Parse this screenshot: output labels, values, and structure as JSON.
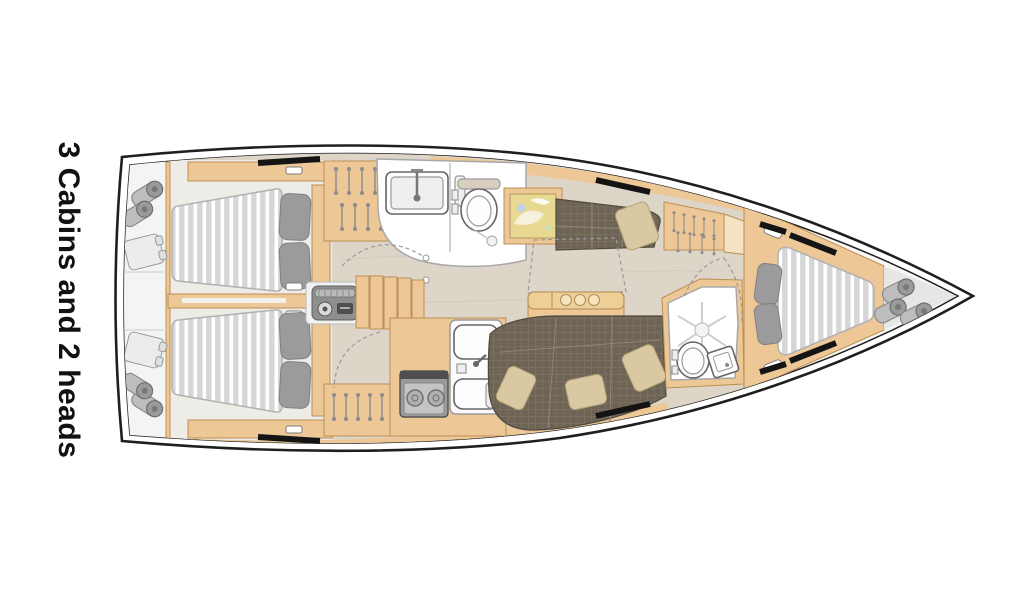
{
  "title": "3 Cabins and 2 heads",
  "plan": {
    "type": "sailboat-interior-floor-plan",
    "orientation": "bow-right",
    "cabins": 3,
    "heads": 2,
    "areas": [
      "aft-cabin-port",
      "aft-cabin-starboard",
      "aft-head",
      "companionway",
      "engine-box",
      "galley",
      "salon-table",
      "chart-table",
      "settee-port",
      "settee-starboard",
      "forward-head",
      "forward-cabin",
      "stern-deck",
      "bow-deck"
    ],
    "furniture_counts": {
      "double_beds": 3,
      "toilets": 2,
      "sinks": 4,
      "showers": 1,
      "stove_burners": 2,
      "fenders_stern": 4,
      "fenders_bow": 3
    }
  },
  "colors": {
    "hull": "#1f1f1f",
    "wood": "#edc795",
    "woodline": "#bb8f55",
    "woodlight": "#f5e2c2",
    "floor": "#dcd5c8",
    "mattress": "#d6d6d6",
    "stripe": "#ffffff",
    "pillow": "#9b9b9b",
    "settee": "#6e6456",
    "cushion": "#d9c8a2",
    "map": "#e7d892",
    "title_color": "#111111"
  }
}
